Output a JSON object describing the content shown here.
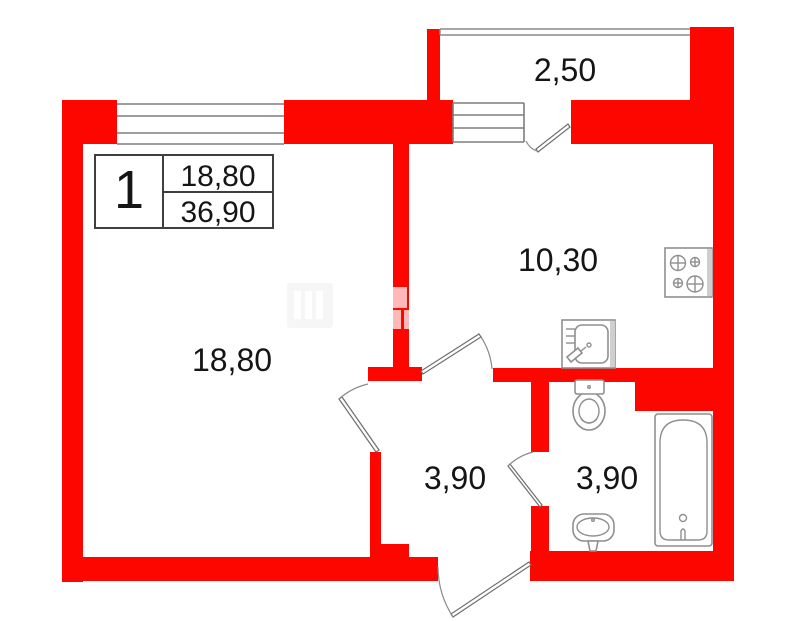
{
  "plan": {
    "type": "apartment-floor-plan",
    "unit_info_table": {
      "room_count": "1",
      "living_area": "18,80",
      "total_area": "36,90"
    },
    "room_labels": {
      "balcony": "2,50",
      "kitchen": "10,30",
      "living_room": "18,80",
      "hallway": "3,90",
      "bathroom": "3,90"
    },
    "fixtures": [
      "stove-icon",
      "kitchen-sink-icon",
      "toilet-icon",
      "bath-sink-icon",
      "bathtub-icon"
    ],
    "colors": {
      "wall": "#fd0600",
      "window_line": "#7d7d7d",
      "door_line": "#6f6f6f",
      "fixture_line": "#8f8f8f",
      "table_border": "#3f3f3f",
      "text": "#151515",
      "background": "#ffffff",
      "watermark": "rgba(255,255,255,0.72)"
    }
  }
}
